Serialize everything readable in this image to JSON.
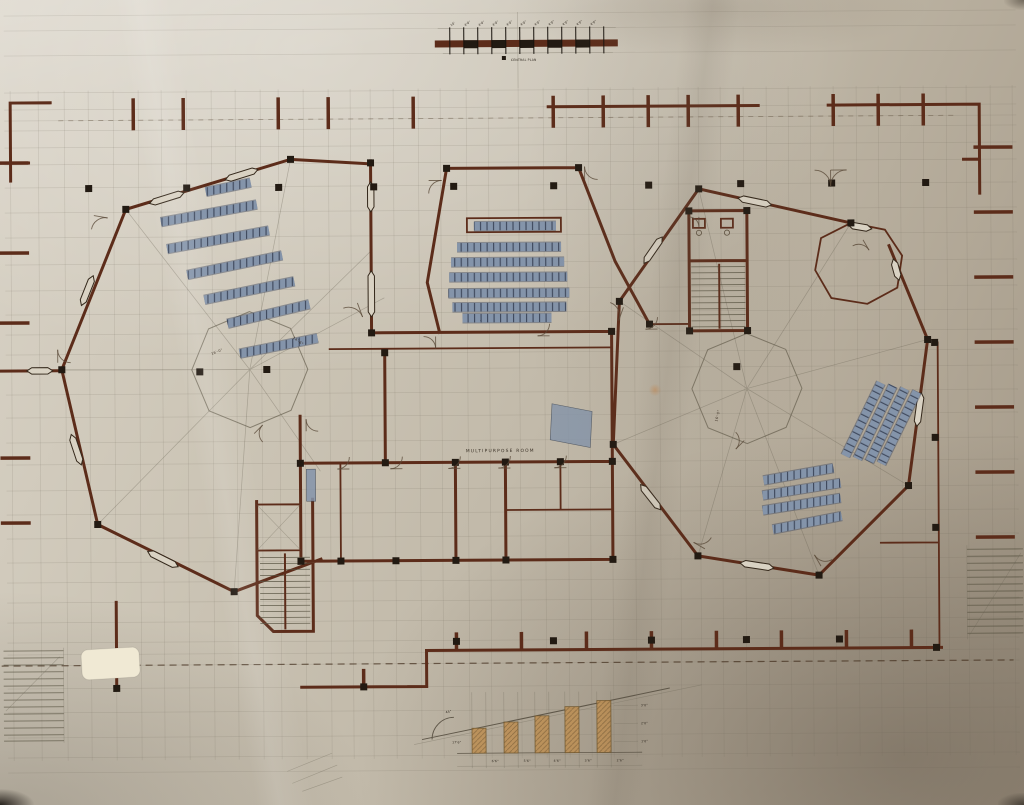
{
  "title": "Central plan floor plan drawing",
  "colors": {
    "wall_brown": "#5c2c1a",
    "ink_black": "#221a12",
    "pencil_gray": "#5f5749",
    "seat_blue": "#8494aa",
    "seat_blue_dark": "#434e63",
    "tan_fill": "#bc9057",
    "patch_cream": "#f0e9d4"
  },
  "scale_bar": {
    "label": "CENTRAL PLAN",
    "ticks_x": [
      452,
      466,
      480,
      494,
      508,
      522,
      536,
      550,
      564,
      578,
      592,
      606
    ],
    "tick_labels": [
      "10'",
      "4'0\"",
      "4'0\"",
      "4'0\"",
      "4'0\"",
      "4'0\"",
      "4'0\"",
      "4'0\"",
      "4'0\"",
      "4'0\"",
      "4'0\""
    ]
  },
  "labels": {
    "multipurpose_room": "MULTIPURPOSE ROOM",
    "left_radial_dim": "16'-0\"",
    "left_radial_dim_2": "14'-6\"",
    "right_radial_dim": "16'-0\""
  },
  "detail_diagram": {
    "angle_label": "45°",
    "base_label": "17'6\"",
    "width_labels": [
      "6'6\"",
      "5'6\"",
      "4'6\"",
      "3'6\"",
      "2'6\""
    ],
    "height_labels": [
      "3'0\"",
      "2'0\"",
      "1'0\""
    ],
    "risers": [
      [
        470,
        728
      ],
      [
        502,
        722
      ],
      [
        533,
        716
      ],
      [
        563,
        707
      ],
      [
        595,
        701
      ]
    ]
  },
  "grid": {
    "v": [
      12,
      40,
      66,
      90,
      115,
      140,
      163,
      188,
      213,
      237,
      262,
      280,
      305,
      330,
      352,
      372,
      395,
      420,
      442,
      468,
      490,
      520,
      545,
      568,
      590,
      612,
      635,
      660,
      680,
      700,
      722,
      745,
      768,
      790,
      812,
      835,
      858,
      880,
      902,
      925,
      948,
      968,
      992,
      1014
    ],
    "h": [
      13,
      28,
      53,
      90,
      107,
      118,
      128,
      145,
      162,
      185,
      210,
      235,
      262,
      288,
      312,
      332,
      352,
      368,
      392,
      415,
      440,
      462,
      488,
      512,
      536,
      560,
      580,
      600,
      620,
      640,
      652,
      663,
      686,
      710,
      735,
      755,
      770
    ]
  },
  "columns": [
    [
      90,
      186
    ],
    [
      188,
      186
    ],
    [
      280,
      186
    ],
    [
      375,
      186
    ],
    [
      455,
      186
    ],
    [
      555,
      186
    ],
    [
      650,
      186
    ],
    [
      742,
      185
    ],
    [
      833,
      185
    ],
    [
      927,
      185
    ],
    [
      455,
      641
    ],
    [
      552,
      641
    ],
    [
      650,
      641
    ],
    [
      745,
      641
    ],
    [
      838,
      641
    ],
    [
      200,
      370
    ],
    [
      267,
      368
    ],
    [
      737,
      368
    ],
    [
      127,
      207
    ],
    [
      292,
      158
    ],
    [
      62,
      367
    ],
    [
      97,
      522
    ],
    [
      233,
      590
    ],
    [
      372,
      162
    ],
    [
      372,
      332
    ],
    [
      448,
      168
    ],
    [
      580,
      168
    ],
    [
      612,
      332
    ],
    [
      612,
      462
    ],
    [
      612,
      560
    ],
    [
      700,
      190
    ],
    [
      852,
      225
    ],
    [
      928,
      342
    ],
    [
      908,
      488
    ],
    [
      818,
      577
    ],
    [
      697,
      557
    ],
    [
      613,
      445
    ],
    [
      620,
      302
    ],
    [
      385,
      352
    ],
    [
      385,
      462
    ],
    [
      300,
      462
    ],
    [
      300,
      560
    ],
    [
      340,
      560
    ],
    [
      395,
      560
    ],
    [
      455,
      462
    ],
    [
      455,
      560
    ],
    [
      505,
      462
    ],
    [
      505,
      560
    ],
    [
      560,
      462
    ],
    [
      650,
      325
    ],
    [
      690,
      212
    ],
    [
      748,
      212
    ],
    [
      690,
      332
    ],
    [
      748,
      332
    ],
    [
      115,
      686
    ],
    [
      362,
      686
    ],
    [
      935,
      345
    ],
    [
      935,
      440
    ],
    [
      935,
      530
    ],
    [
      935,
      650
    ]
  ],
  "windows": [
    [
      168,
      196,
      36,
      -17
    ],
    [
      243,
      173,
      34,
      -17
    ],
    [
      88,
      288,
      32,
      -68
    ],
    [
      76,
      447,
      32,
      72
    ],
    [
      162,
      557,
      34,
      27
    ],
    [
      40,
      368,
      26,
      0
    ],
    [
      372,
      196,
      30,
      90
    ],
    [
      372,
      293,
      46,
      90
    ],
    [
      756,
      203,
      34,
      12
    ],
    [
      654,
      251,
      32,
      -55
    ],
    [
      919,
      412,
      34,
      98
    ],
    [
      650,
      498,
      32,
      52
    ],
    [
      756,
      567,
      34,
      9
    ],
    [
      861,
      229,
      24,
      10
    ],
    [
      897,
      272,
      22,
      75
    ]
  ],
  "door_arcs": [
    [
      95,
      213,
      14,
      100
    ],
    [
      358,
      302,
      15,
      160
    ],
    [
      430,
      180,
      13,
      90
    ],
    [
      586,
      180,
      13,
      0
    ],
    [
      436,
      336,
      12,
      180
    ],
    [
      550,
      336,
      12,
      270
    ],
    [
      306,
      430,
      12,
      0
    ],
    [
      349,
      468,
      12,
      270
    ],
    [
      402,
      468,
      12,
      270
    ],
    [
      460,
      468,
      12,
      270
    ],
    [
      510,
      468,
      12,
      270
    ],
    [
      566,
      468,
      12,
      270
    ],
    [
      624,
      308,
      14,
      200
    ],
    [
      658,
      330,
      12,
      270
    ],
    [
      704,
      550,
      13,
      300
    ],
    [
      820,
      568,
      13,
      330
    ],
    [
      864,
      242,
      12,
      150
    ],
    [
      700,
      218,
      10,
      180
    ],
    [
      254,
      432,
      12,
      45
    ],
    [
      744,
      442,
      12,
      225
    ],
    [
      58,
      360,
      13,
      0
    ],
    [
      832,
      172,
      16,
      90
    ],
    [
      832,
      172,
      16,
      180
    ]
  ],
  "seat_groups": [
    {
      "name": "left-classroom-seats",
      "rows": [
        [
          207,
          190,
          252,
          181
        ],
        [
          162,
          220,
          258,
          203
        ],
        [
          168,
          247,
          270,
          229
        ],
        [
          188,
          273,
          283,
          254
        ],
        [
          205,
          298,
          295,
          280
        ],
        [
          228,
          322,
          310,
          303
        ],
        [
          240,
          352,
          318,
          337
        ]
      ]
    },
    {
      "name": "auditorium-seats",
      "rows": [
        [
          475,
          226,
          557,
          226
        ],
        [
          458,
          247,
          562,
          247
        ],
        [
          452,
          262,
          565,
          262
        ],
        [
          450,
          277,
          568,
          277
        ],
        [
          449,
          293,
          570,
          293
        ],
        [
          453,
          307,
          567,
          307
        ],
        [
          463,
          318,
          552,
          318
        ]
      ]
    },
    {
      "name": "right-upper-seats",
      "rows": [
        [
          845,
          458,
          881,
          385
        ],
        [
          857,
          461,
          893,
          388
        ],
        [
          869,
          464,
          905,
          391
        ],
        [
          881,
          466,
          917,
          394
        ]
      ]
    },
    {
      "name": "right-lower-seats",
      "rows": [
        [
          763,
          482,
          833,
          470
        ],
        [
          762,
          497,
          840,
          485
        ],
        [
          762,
          512,
          840,
          500
        ],
        [
          772,
          531,
          841,
          518
        ]
      ]
    }
  ]
}
